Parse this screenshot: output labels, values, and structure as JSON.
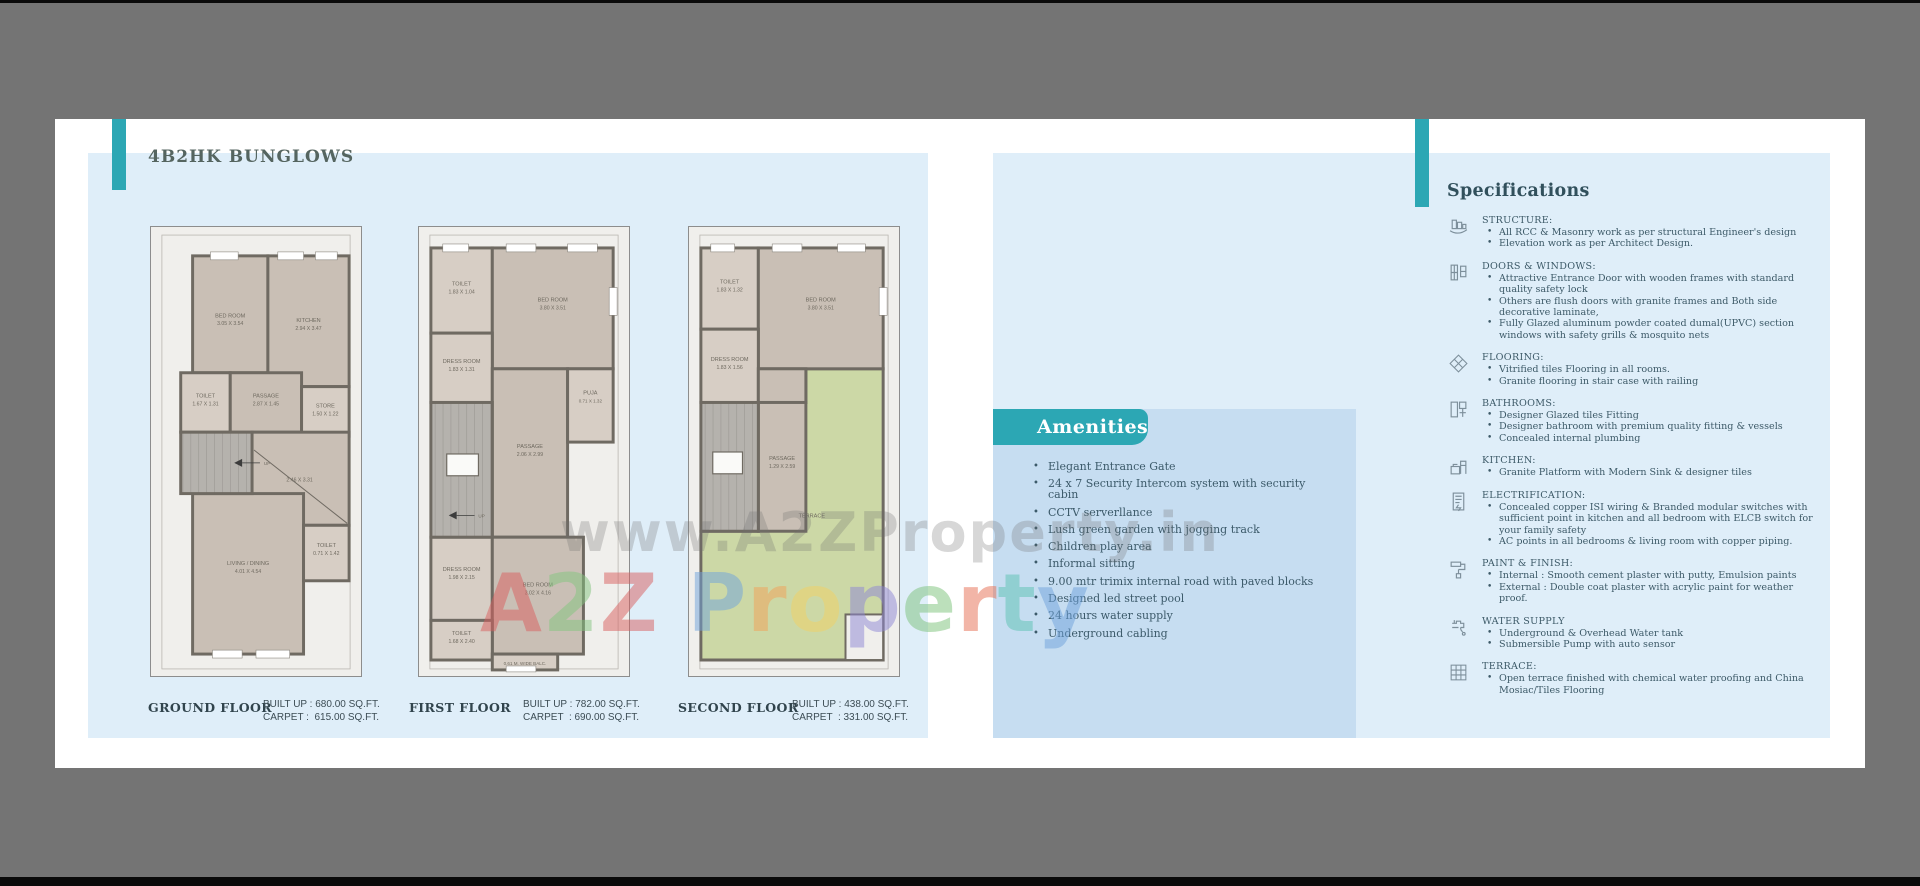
{
  "brochure": {
    "title": "4B2HK BUNGLOWS",
    "watermark": {
      "url_text": "www.A2ZProperty.in",
      "brand_letters": [
        {
          "ch": "A",
          "color": "#d95f5f"
        },
        {
          "ch": "2",
          "color": "#83c57f"
        },
        {
          "ch": "Z",
          "color": "#d95f5f"
        },
        {
          "ch": " ",
          "color": "#ffffff"
        },
        {
          "ch": "P",
          "color": "#6fa3dc"
        },
        {
          "ch": "r",
          "color": "#f2a258"
        },
        {
          "ch": "o",
          "color": "#f2d264"
        },
        {
          "ch": "p",
          "color": "#8e86d6"
        },
        {
          "ch": "e",
          "color": "#7cc27a"
        },
        {
          "ch": "r",
          "color": "#e76e52"
        },
        {
          "ch": "t",
          "color": "#5cc2b2"
        },
        {
          "ch": "y",
          "color": "#6fa3dc"
        }
      ]
    }
  },
  "floor_plans": [
    {
      "name": "GROUND FLOOR",
      "built_up": "BUILT UP : 680.00 SQ.FT.",
      "carpet": "CARPET :  615.00 SQ.FT.",
      "rooms": {
        "bed": {
          "name": "BED ROOM",
          "dims": "3.05 X 3.54"
        },
        "kitchen": {
          "name": "KITCHEN",
          "dims": "2.94 X 3.47"
        },
        "toilet": {
          "name": "TOILET",
          "dims": "1.67 X 1.31"
        },
        "passage": {
          "name": "PASSAGE",
          "dims": "2.87 X 1.45"
        },
        "store": {
          "name": "STORE",
          "dims": "1.50 X 1.22"
        },
        "open": {
          "name": "",
          "dims": "2.46 X 3.31"
        },
        "living": {
          "name": "LIVING / DINING",
          "dims": "4.01 X 4.54"
        },
        "toilet2": {
          "name": "TOILET",
          "dims": "0.71 X 1.42"
        },
        "up": "UP"
      }
    },
    {
      "name": "FIRST FLOOR",
      "built_up": "BUILT UP : 782.00 SQ.FT.",
      "carpet": "CARPET  : 690.00 SQ.FT.",
      "rooms": {
        "toilet": {
          "name": "TOILET",
          "dims": "1.83 X 1.04"
        },
        "bed": {
          "name": "BED ROOM",
          "dims": "3.80 X 3.51"
        },
        "dress": {
          "name": "DRESS ROOM",
          "dims": "1.83 X 1.31"
        },
        "passage": {
          "name": "PASSAGE",
          "dims": "2.06 X 2.99"
        },
        "puja": {
          "name": "PUJA",
          "dims": "0.71 X 1.32"
        },
        "dress2": {
          "name": "DRESS ROOM",
          "dims": "1.98 X 2.15"
        },
        "bed2": {
          "name": "BED ROOM",
          "dims": "3.02 X 4.16"
        },
        "toilet2": {
          "name": "TOILET",
          "dims": "1.68 X 2.40"
        },
        "balcony": "0.61 M. WIDE BALC.",
        "up": "UP"
      }
    },
    {
      "name": "SECOND FLOOR",
      "built_up": "BUILT UP : 438.00 SQ.FT.",
      "carpet": "CARPET  : 331.00 SQ.FT.",
      "rooms": {
        "toilet": {
          "name": "TOILET",
          "dims": "1.83 X 1.32"
        },
        "bed": {
          "name": "BED ROOM",
          "dims": "3.80 X 3.51"
        },
        "dress": {
          "name": "DRESS ROOM",
          "dims": "1.83 X 1.56"
        },
        "passage": {
          "name": "PASSAGE",
          "dims": "1.29 X 2.59"
        },
        "terrace": {
          "name": "TERRACE",
          "dims": ""
        }
      }
    }
  ],
  "amenities": {
    "title": "Amenities",
    "items": [
      "Elegant Entrance Gate",
      "24 x 7 Security Intercom system with security cabin",
      "CCTV serverllance",
      "Lush green garden with jogging track",
      "Children play area",
      "Informal sitting",
      "9.00 mtr trimix internal road with paved blocks",
      "Designed led street pool",
      "24 hours water supply",
      "Underground cabling"
    ]
  },
  "specifications": {
    "title": "Specifications",
    "sections": [
      {
        "icon": "structure-icon",
        "heading": "STRUCTURE:",
        "items": [
          "All RCC & Masonry work as per structural Engineer's design",
          "Elevation work as per Architect Design."
        ]
      },
      {
        "icon": "doors-windows-icon",
        "heading": "DOORS & WINDOWS:",
        "items": [
          "Attractive Entrance Door with wooden frames with standard quality safety lock",
          "Others are flush doors with granite frames and Both side decorative laminate,",
          "Fully Glazed aluminum powder coated dumal(UPVC) section windows with safety grills & mosquito nets"
        ]
      },
      {
        "icon": "flooring-icon",
        "heading": "FLOORING:",
        "items": [
          "Vitrified tiles Flooring in all rooms.",
          "Granite flooring in stair case with railing"
        ]
      },
      {
        "icon": "bathrooms-icon",
        "heading": "BATHROOMS:",
        "items": [
          "Designer Glazed tiles Fitting",
          "Designer bathroom with premium quality fitting & vessels",
          "Concealed internal plumbing"
        ]
      },
      {
        "icon": "kitchen-icon",
        "heading": "KITCHEN:",
        "items": [
          "Granite Platform with Modern Sink & designer tiles"
        ]
      },
      {
        "icon": "electrification-icon",
        "heading": "ELECTRIFICATION:",
        "items": [
          "Concealed copper ISI wiring & Branded modular switches with sufficient point in kitchen and all bedroom with ELCB switch for your family safety",
          "AC points in all bedrooms & living room with copper piping."
        ]
      },
      {
        "icon": "paint-finish-icon",
        "heading": "PAINT & FINISH:",
        "items": [
          "Internal : Smooth cement plaster with putty, Emulsion paints",
          "External : Double coat plaster with acrylic paint for weather proof."
        ]
      },
      {
        "icon": "water-supply-icon",
        "heading": "WATER SUPPLY",
        "items": [
          "Underground & Overhead Water tank",
          "Submersible Pump with auto sensor"
        ]
      },
      {
        "icon": "terrace-icon",
        "heading": "TERRACE:",
        "items": [
          "Open terrace finished with chemical water proofing and China Mosiac/Tiles Flooring"
        ]
      }
    ]
  }
}
